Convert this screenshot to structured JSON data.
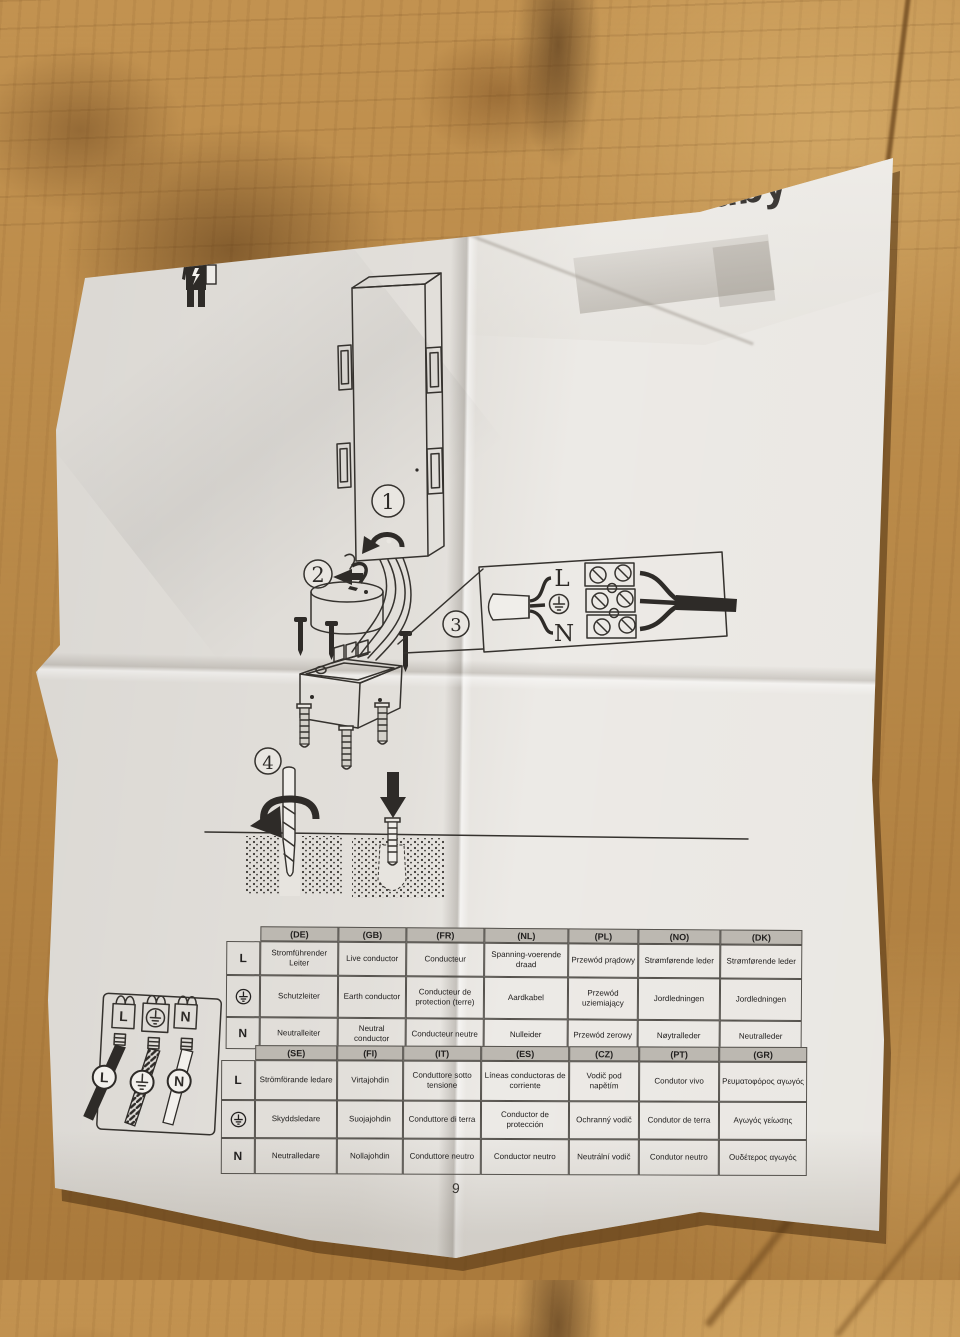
{
  "photo": {
    "brand_logo": "Lindby",
    "show_through_text": "Revision 02.1",
    "page_number": "9"
  },
  "steps": [
    "1",
    "2",
    "3",
    "4"
  ],
  "wiring_labels": {
    "live": "L",
    "neutral": "N",
    "earth_symbol": "⏚"
  },
  "icons": {
    "electrician": "electrician-worker-icon",
    "earth": "earth-ground-symbol-icon",
    "rotate": "rotate-arrow-icon",
    "press_down": "down-arrow-icon",
    "drill": "drill-bit-icon"
  },
  "tables": [
    {
      "headers": [
        "(DE)",
        "(GB)",
        "(FR)",
        "(NL)",
        "(PL)",
        "(NO)",
        "(DK)"
      ],
      "rows": [
        {
          "symbol": "L",
          "cells": [
            "Stromführender Leiter",
            "Live conductor",
            "Conducteur",
            "Spanning-voerende draad",
            "Przewód prądowy",
            "Strømførende leder",
            "Strømførende leder"
          ]
        },
        {
          "symbol": "earth",
          "cells": [
            "Schutzleiter",
            "Earth conductor",
            "Conducteur de protection (terre)",
            "Aardkabel",
            "Przewód uziemiający",
            "Jordledningen",
            "Jordledningen"
          ]
        },
        {
          "symbol": "N",
          "cells": [
            "Neutralleiter",
            "Neutral conductor",
            "Conducteur neutre",
            "Nulleider",
            "Przewód zerowy",
            "Nøytralleder",
            "Neutralleder"
          ]
        }
      ]
    },
    {
      "headers": [
        "(SE)",
        "(FI)",
        "(IT)",
        "(ES)",
        "(CZ)",
        "(PT)",
        "(GR)"
      ],
      "rows": [
        {
          "symbol": "L",
          "cells": [
            "Strömförande ledare",
            "Virtajohdin",
            "Conduttore sotto tensione",
            "Líneas conductoras de corriente",
            "Vodič pod napětím",
            "Condutor vivo",
            "Ρευματοφόρος αγωγός"
          ]
        },
        {
          "symbol": "earth",
          "cells": [
            "Skyddsledare",
            "Suojajohdin",
            "Conduttore di terra",
            "Conductor de protección",
            "Ochranný vodič",
            "Condutor de terra",
            "Αγωγός γείωσης"
          ]
        },
        {
          "symbol": "N",
          "cells": [
            "Neutralledare",
            "Nollajohdin",
            "Conduttore neutro",
            "Conductor neutro",
            "Neutrální vodič",
            "Condutor neutro",
            "Ουδέτερος αγωγός"
          ]
        }
      ]
    }
  ],
  "colors": {
    "paper": "#e7e4df",
    "ink": "#2e2b28",
    "table_header_bg": "#bcb8b1",
    "wood": "#b8894a"
  }
}
